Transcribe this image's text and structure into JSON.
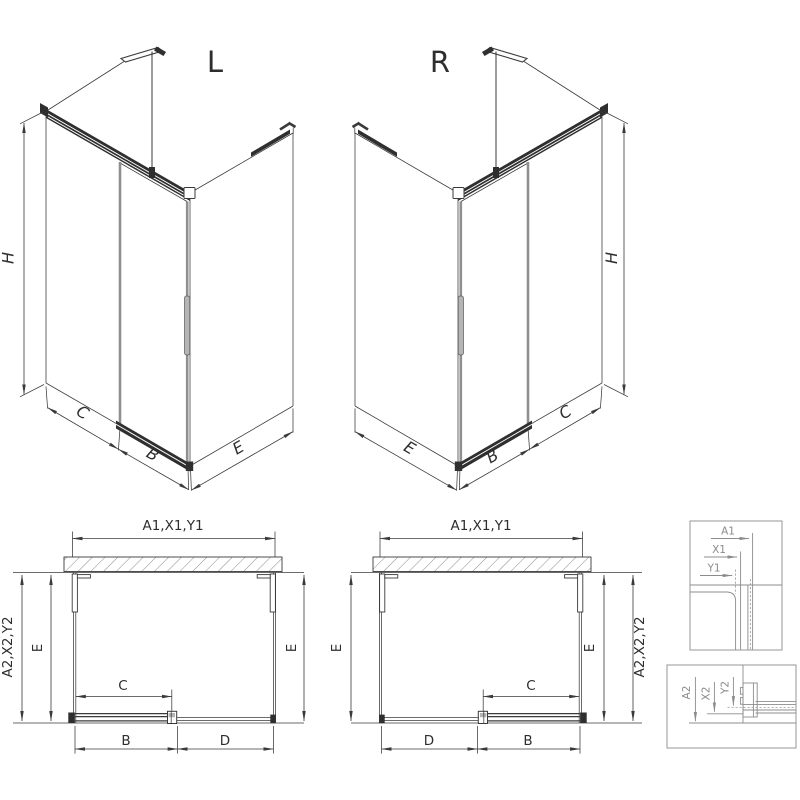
{
  "iso_left": {
    "title": "L",
    "dim_h": "H",
    "dim_c": "C",
    "dim_b": "B",
    "dim_e": "E"
  },
  "iso_right": {
    "title": "R",
    "dim_h": "H",
    "dim_c": "C",
    "dim_b": "B",
    "dim_e": "E"
  },
  "plan_left": {
    "dim_top": "A1,X1,Y1",
    "dim_outer": "A2,X2,Y2",
    "dim_e_left": "E",
    "dim_e_right": "E",
    "dim_c": "C",
    "dim_b": "B",
    "dim_d": "D"
  },
  "plan_right": {
    "dim_top": "A1,X1,Y1",
    "dim_outer": "A2,X2,Y2",
    "dim_e_left": "E",
    "dim_e_right": "E",
    "dim_c": "C",
    "dim_b": "B",
    "dim_d": "D"
  },
  "detail_top": {
    "dim_a1": "A1",
    "dim_x1": "X1",
    "dim_y1": "Y1"
  },
  "detail_bottom": {
    "dim_a2": "A2",
    "dim_x2": "X2",
    "dim_y2": "Y2"
  },
  "colors": {
    "line": "#3a3a3a",
    "detail_gray": "#8c8c8c",
    "glass_edge": "#8f8f8f",
    "handle_fill": "#b5b5b5",
    "rail_fill": "#2f2f2f",
    "background": "#ffffff"
  }
}
